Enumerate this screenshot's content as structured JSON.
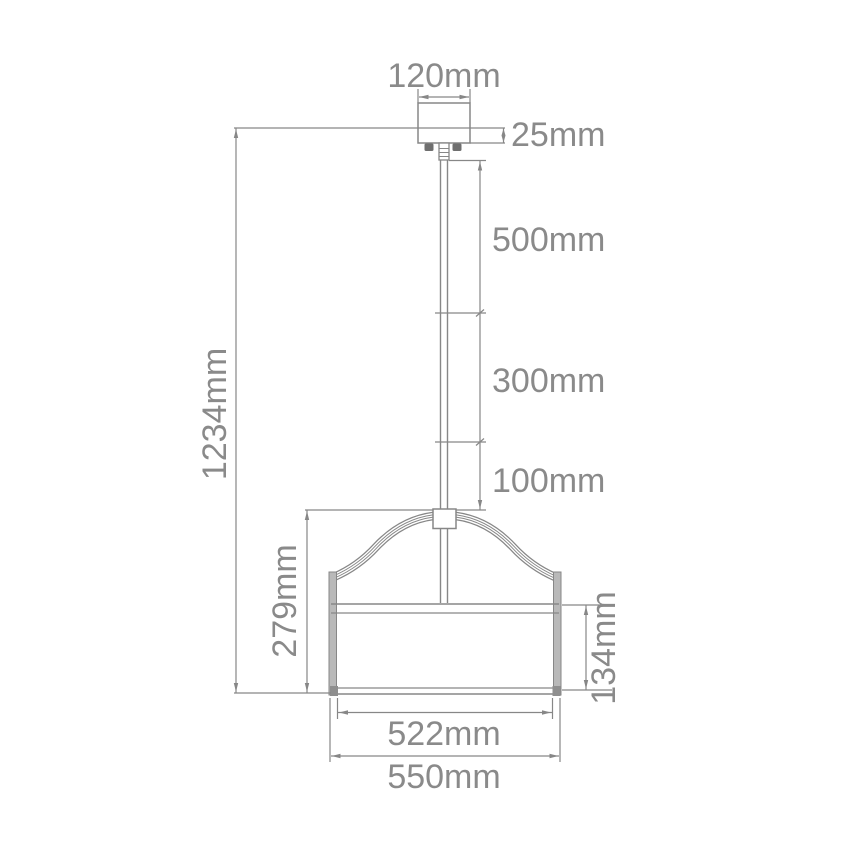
{
  "diagram": {
    "type": "pendant-light-dimension-drawing",
    "unit": "mm",
    "colors": {
      "line": "#878787",
      "text": "#8a8a8a",
      "background": "#ffffff",
      "shade_rim_fill": "#b9b9b9",
      "screw_fill": "#6f6f6f"
    },
    "dimensions": {
      "canopy_width": "120mm",
      "canopy_height": "25mm",
      "rod_section_top": "500mm",
      "rod_section_middle": "300mm",
      "rod_section_bottom": "100mm",
      "overall_height": "1234mm",
      "frame_height": "279mm",
      "shade_height": "134mm",
      "shade_inner_width": "522mm",
      "shade_outer_width": "550mm"
    }
  }
}
